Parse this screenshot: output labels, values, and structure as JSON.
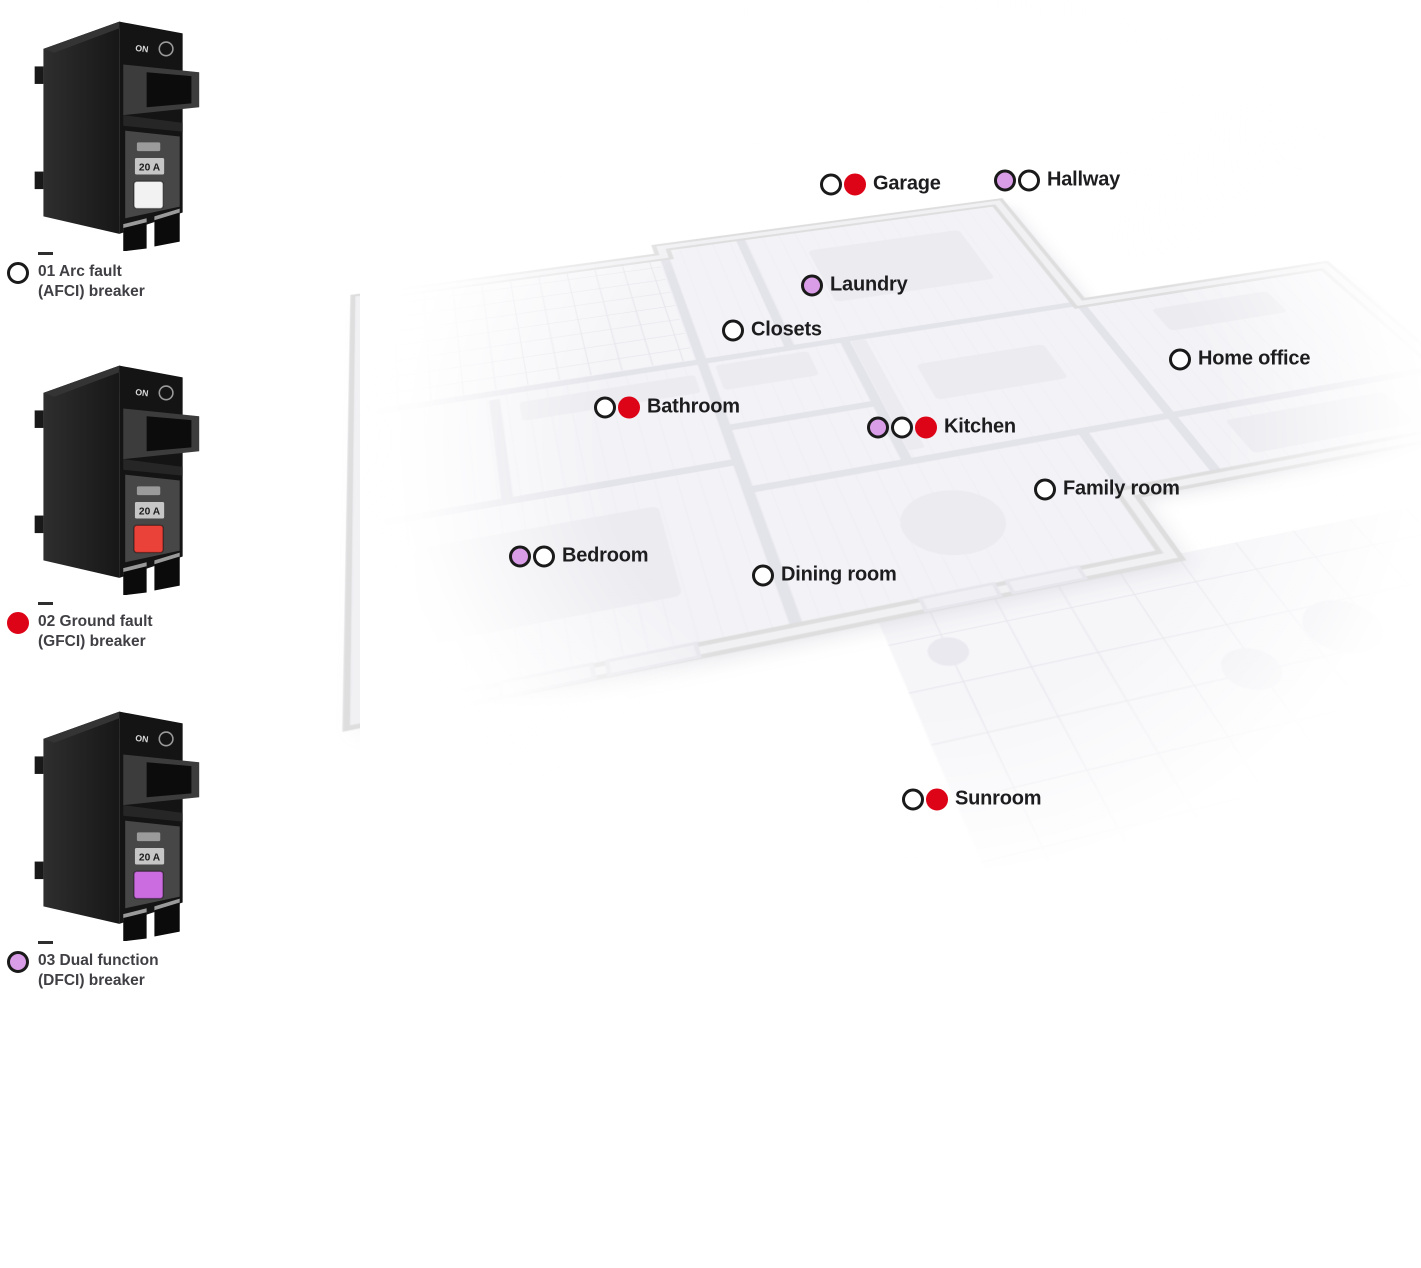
{
  "legend": {
    "items": [
      {
        "line1": "01 Arc fault",
        "line2": "(AFCI) breaker",
        "dot": "afci",
        "button_color": "#f2f2f2"
      },
      {
        "line1": "02 Ground fault",
        "line2": "(GFCI) breaker",
        "dot": "gfci",
        "button_color": "#ea4238"
      },
      {
        "line1": "03 Dual function",
        "line2": "(DFCI) breaker",
        "dot": "dfci",
        "button_color": "#cb6ce0"
      }
    ]
  },
  "breaker": {
    "on_label": "ON",
    "amp_label": "20 A"
  },
  "dot_types": {
    "afci": {
      "fill": "#ffffff",
      "ring": "#1a1a1a"
    },
    "gfci": {
      "fill": "#de0418",
      "ring": "#de0418"
    },
    "dfci": {
      "fill": "#d99ce6",
      "ring": "#1a1a1a"
    }
  },
  "rooms": [
    {
      "name": "Garage",
      "dots": [
        "afci",
        "gfci"
      ],
      "x": 820,
      "y": 184
    },
    {
      "name": "Hallway",
      "dots": [
        "dfci",
        "afci"
      ],
      "x": 994,
      "y": 180
    },
    {
      "name": "Laundry",
      "dots": [
        "dfci"
      ],
      "x": 801,
      "y": 285
    },
    {
      "name": "Closets",
      "dots": [
        "afci"
      ],
      "x": 722,
      "y": 330
    },
    {
      "name": "Home office",
      "dots": [
        "afci"
      ],
      "x": 1169,
      "y": 359
    },
    {
      "name": "Bathroom",
      "dots": [
        "afci",
        "gfci"
      ],
      "x": 594,
      "y": 407
    },
    {
      "name": "Kitchen",
      "dots": [
        "dfci",
        "afci",
        "gfci"
      ],
      "x": 867,
      "y": 427
    },
    {
      "name": "Family room",
      "dots": [
        "afci"
      ],
      "x": 1034,
      "y": 489
    },
    {
      "name": "Bedroom",
      "dots": [
        "dfci",
        "afci"
      ],
      "x": 509,
      "y": 556
    },
    {
      "name": "Dining room",
      "dots": [
        "afci"
      ],
      "x": 752,
      "y": 575
    },
    {
      "name": "Sunroom",
      "dots": [
        "afci",
        "gfci"
      ],
      "x": 902,
      "y": 799
    }
  ]
}
